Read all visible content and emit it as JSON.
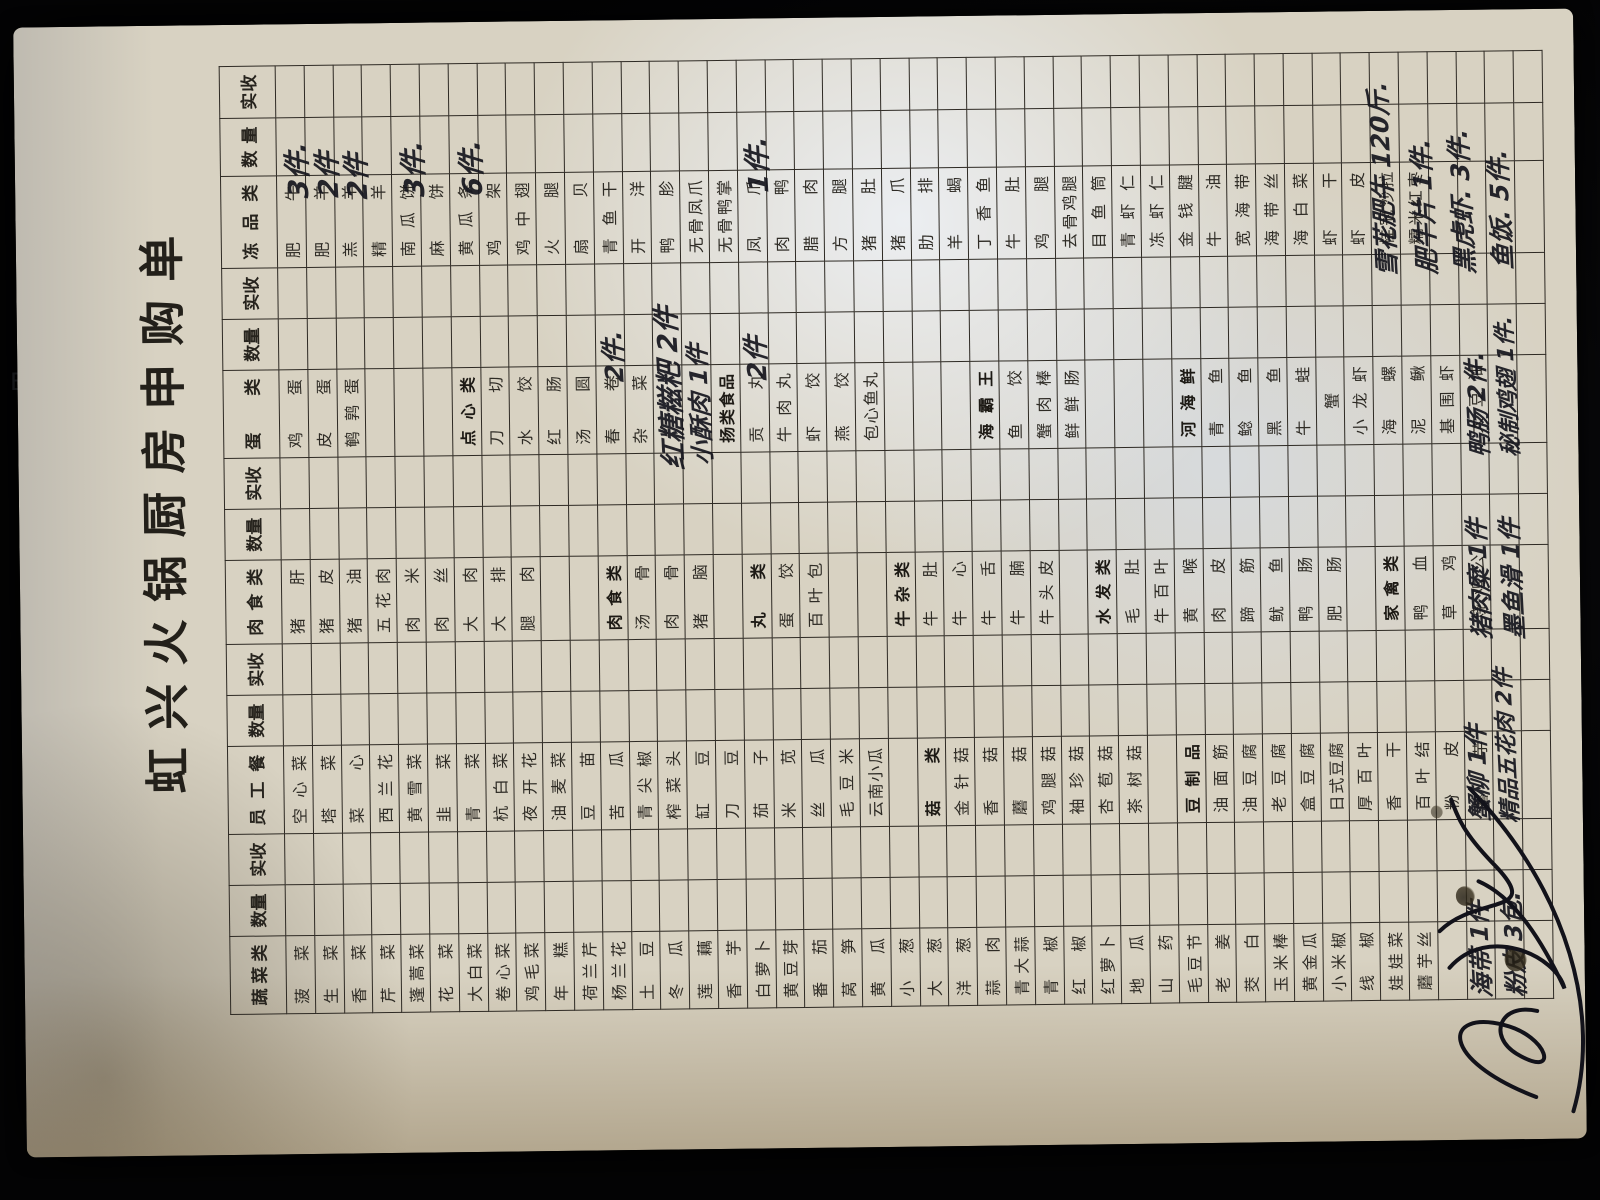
{
  "title": "虹兴火锅厨房申购单",
  "background": {
    "artifacts": [
      "+",
      "Ente"
    ]
  },
  "colors": {
    "paper": "#d8d2c2",
    "printed_ink": "#2e2b25",
    "handwriting_ink": "#17171f",
    "grid": "#2e2a24",
    "sheen": "#f1f6ff"
  },
  "table": {
    "columns": [
      {
        "label": "蔬菜类",
        "w": 78
      },
      {
        "label": "数量",
        "w": 50
      },
      {
        "label": "实收",
        "w": 46
      },
      {
        "label": "员工餐",
        "w": 88
      },
      {
        "label": "数量",
        "w": 50
      },
      {
        "label": "实收",
        "w": 46
      },
      {
        "label": "肉食类",
        "w": 84
      },
      {
        "label": "数量",
        "w": 50
      },
      {
        "label": "实收",
        "w": 46
      },
      {
        "label": "蛋类",
        "w": 88
      },
      {
        "label": "数量",
        "w": 50
      },
      {
        "label": "实收",
        "w": 46
      },
      {
        "label": "冻品类",
        "w": 92
      },
      {
        "label": "数量",
        "w": 58
      },
      {
        "label": "实收",
        "w": 52
      }
    ],
    "rows": [
      [
        "菠菜",
        "空心菜",
        "猪肝",
        "鸡蛋",
        "肥牛"
      ],
      [
        "生菜",
        "塔菜",
        "猪皮",
        "皮蛋",
        "肥羊"
      ],
      [
        "香菜",
        "菜心",
        "猪油",
        "鹌鹑蛋",
        "羔羊"
      ],
      [
        "芹菜",
        "西兰花",
        "五花肉",
        "",
        "精羊"
      ],
      [
        "蓬蒿菜",
        "黄雪菜",
        "肉米",
        "",
        "南瓜饼"
      ],
      [
        "花菜",
        "韭菜",
        "肉丝",
        "",
        "麻饼"
      ],
      [
        "大白菜",
        "青菜",
        "大肉",
        "*点心类",
        "黄瓜条"
      ],
      [
        "卷心菜",
        "杭白菜",
        "大排",
        "刀切",
        "鸡架"
      ],
      [
        "鸡毛菜",
        "夜开花",
        "腿肉",
        "水饺",
        "鸡中翅"
      ],
      [
        "年糕",
        "油麦菜",
        "",
        "红肠",
        "火腿"
      ],
      [
        "荷兰芹",
        "豆苗",
        "",
        "汤圆",
        "扇贝"
      ],
      [
        "杨兰花",
        "苦瓜",
        "*肉食类",
        "春卷",
        "青鱼干"
      ],
      [
        "土豆",
        "青尖椒",
        "汤骨",
        "杂菜",
        "开洋"
      ],
      [
        "冬瓜",
        "榨菜头",
        "肉骨",
        "",
        "鸭胗"
      ],
      [
        "莲藕",
        "缸豆",
        "猪脑",
        "",
        "无骨凤爪"
      ],
      [
        "香芋",
        "刀豆",
        "",
        "*扬类食品",
        "无骨鸭掌"
      ],
      [
        "白萝卜",
        "茄子",
        "*丸类",
        "贡丸",
        "凤爪"
      ],
      [
        "黄豆芽",
        "米苋",
        "蛋饺",
        "牛肉丸",
        "肉鸭"
      ],
      [
        "番茄",
        "丝瓜",
        "百叶包",
        "虾饺",
        "腊肉"
      ],
      [
        "莴笋",
        "毛豆米",
        "",
        "燕饺",
        "方腿"
      ],
      [
        "黄瓜",
        "云南小瓜",
        "",
        "包心鱼丸",
        "猪肚"
      ],
      [
        "小葱",
        "",
        "*牛杂类",
        "",
        "猪爪"
      ],
      [
        "大葱",
        "*菇类",
        "牛肚",
        "",
        "肋排"
      ],
      [
        "洋葱",
        "金针菇",
        "牛心",
        "",
        "羊蝎"
      ],
      [
        "蒜肉",
        "香菇",
        "牛舌",
        "*海霸王",
        "丁香鱼"
      ],
      [
        "青大蒜",
        "蘑菇",
        "牛腩",
        "鱼饺",
        "牛肚"
      ],
      [
        "青椒",
        "鸡腿菇",
        "牛头皮",
        "蟹肉棒",
        "鸡腿"
      ],
      [
        "红椒",
        "袖珍菇",
        "",
        "鲜鲜肠",
        "去骨鸡腿"
      ],
      [
        "红萝卜",
        "杏苞菇",
        "*水发类",
        "",
        "目鱼筒"
      ],
      [
        "地瓜",
        "茶树菇",
        "毛肚",
        "",
        "青虾仁"
      ],
      [
        "山药",
        "",
        "牛百叶",
        "",
        "冻虾仁"
      ],
      [
        "毛豆节",
        "*豆制品",
        "黄喉",
        "*河海鲜",
        "金钱腱"
      ],
      [
        "老姜",
        "油面筋",
        "肉皮",
        "青鱼",
        "牛油"
      ],
      [
        "茭白",
        "油豆腐",
        "蹄筋",
        "鲶鱼",
        "宽海带"
      ],
      [
        "玉米棒",
        "老豆腐",
        "鱿鱼",
        "黑鱼",
        "海带丝"
      ],
      [
        "黄金瓜",
        "盒豆腐",
        "鸭肠",
        "牛蛙",
        "海白菜"
      ],
      [
        "小米椒",
        "日式豆腐",
        "肥肠",
        "蟹",
        "虾干"
      ],
      [
        "线椒",
        "厚百叶",
        "",
        "小龙虾",
        "虾皮"
      ],
      [
        "娃娃菜",
        "香干",
        "*家禽类",
        "海螺",
        "桂冠沙拉"
      ],
      [
        "蘑芋丝",
        "百叶结",
        "鸭血",
        "泥鳅",
        "糯米红枣"
      ],
      [
        "",
        "粉皮",
        "草鸡",
        "基围虾",
        ""
      ],
      [
        "",
        "蘑芋",
        "烧鸡公",
        "大豆油",
        ""
      ],
      [
        "",
        "",
        "",
        "",
        ""
      ],
      [
        "",
        "",
        "",
        "",
        ""
      ]
    ]
  },
  "handwriting": [
    {
      "text": "3件.",
      "x": 958,
      "y": 262,
      "size": 27
    },
    {
      "text": "2件",
      "x": 958,
      "y": 292,
      "size": 27
    },
    {
      "text": "2件",
      "x": 956,
      "y": 321,
      "size": 27
    },
    {
      "text": "3件.",
      "x": 958,
      "y": 378,
      "size": 27
    },
    {
      "text": "6件.",
      "x": 958,
      "y": 436,
      "size": 27
    },
    {
      "text": "1件.",
      "x": 958,
      "y": 722,
      "size": 27
    },
    {
      "text": "2件.",
      "x": 770,
      "y": 578,
      "size": 25
    },
    {
      "text": "红糖糍粑 2件",
      "x": 682,
      "y": 634,
      "size": 27
    },
    {
      "text": "小酥肉 1件",
      "x": 686,
      "y": 665,
      "size": 24
    },
    {
      "text": "2件",
      "x": 770,
      "y": 720,
      "size": 26
    },
    {
      "text": "雪花肥牛 120斤.",
      "x": 866,
      "y": 1352,
      "size": 25
    },
    {
      "text": "肥牛片 1件.",
      "x": 868,
      "y": 1392,
      "size": 25
    },
    {
      "text": "黑虎虾. 3件.",
      "x": 868,
      "y": 1430,
      "size": 25
    },
    {
      "text": "鱼饭. 5件.",
      "x": 872,
      "y": 1468,
      "size": 25
    },
    {
      "text": "鸭肠 2件.",
      "x": 684,
      "y": 1442,
      "size": 24
    },
    {
      "text": "秘制鸡翅 1件.",
      "x": 684,
      "y": 1475,
      "size": 22
    },
    {
      "text": "猪肉糜 1件",
      "x": 502,
      "y": 1442,
      "size": 24
    },
    {
      "text": "墨鱼滑 1件",
      "x": 502,
      "y": 1475,
      "size": 24
    },
    {
      "text": "蟹柳 1件",
      "x": 320,
      "y": 1438,
      "size": 24
    },
    {
      "text": "精品五花肉 2件",
      "x": 318,
      "y": 1470,
      "size": 22
    },
    {
      "text": "海带 1件",
      "x": 144,
      "y": 1438,
      "size": 24
    },
    {
      "text": "粉皮 3包.",
      "x": 144,
      "y": 1472,
      "size": 24
    }
  ],
  "signature": {
    "legible": false
  }
}
